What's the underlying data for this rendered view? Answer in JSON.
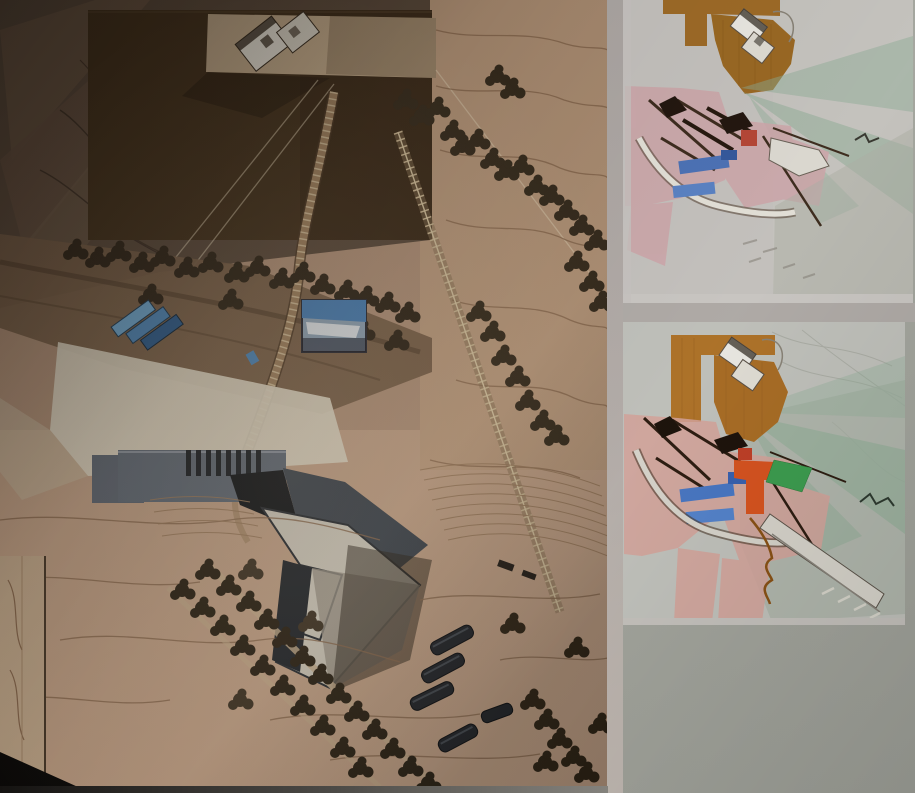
{
  "board": {
    "background_color": "#a8aaa2",
    "margin_gap_color": "#b6afab",
    "regions": {
      "site_model_photo": {
        "palette": {
          "terrain_mid": "#b3937a",
          "terrain_light": "#c3a287",
          "shadow_zone": "#5e4d3e",
          "dark_field": "#46341f",
          "pad": "#c5ad8d",
          "model_white": "#e9e4d8",
          "plaza_white": "#ded6c2",
          "museum_gray": "#5f6772",
          "museum_dark": "#23272c",
          "water_blue": "#4f87b8",
          "water_blue_light": "#6fa8d0",
          "tree_dark": "#32281b",
          "contour_line": "#8a6a4f",
          "bridge_tan": "#a08260"
        },
        "features": [
          "contour-terrain",
          "hilltop-building-model",
          "cable-lines",
          "arc-bridge",
          "stepped-path",
          "tree-rows",
          "water-feature",
          "inset-blue-roof-model",
          "white-plaza",
          "museum-building-complex",
          "tree-allee",
          "barrel-vault-sheds",
          "terrace-lines"
        ]
      },
      "masterplan_diagram_top": {
        "palette": {
          "paper": "#c7c4c0",
          "field_brown": "#a06c28",
          "zone_pink": "#d0a8ac",
          "wedge_green": "#8fae97",
          "water_blue": "#4e74b8",
          "accent_red": "#b84838",
          "line_brown": "#3f2e20",
          "band_white": "#e6e3da",
          "field_gray_green": "#b0b2a8"
        },
        "features": [
          "brown-orchard-field",
          "white-building-icon",
          "green-view-wedges",
          "pink-program-zones",
          "blue-water-strips",
          "red-accent-square",
          "white-curved-band",
          "dark-path-lines"
        ]
      },
      "masterplan_diagram_bottom": {
        "palette": {
          "paper": "#c2c3bd",
          "field_brown": "#b0742a",
          "zone_pink": "#d6a59c",
          "wedge_green": "#8fae97",
          "water_blue": "#4a78c4",
          "accent_orange": "#d85420",
          "accent_green": "#3d9e50",
          "accent_red": "#c04028",
          "line_brown": "#2e1e12",
          "band_white": "#d8d5cc",
          "squiggle_brown": "#8a5216",
          "field_gray_green": "#a9b2a6"
        },
        "features": [
          "brown-orchard-field",
          "white-building-icon",
          "green-view-wedges",
          "pink-program-zones",
          "blue-water-strips",
          "orange-accent-shape",
          "green-accent-parallelogram",
          "white-curved-band",
          "diagonal-road-band",
          "brown-squiggle-path"
        ]
      }
    }
  }
}
